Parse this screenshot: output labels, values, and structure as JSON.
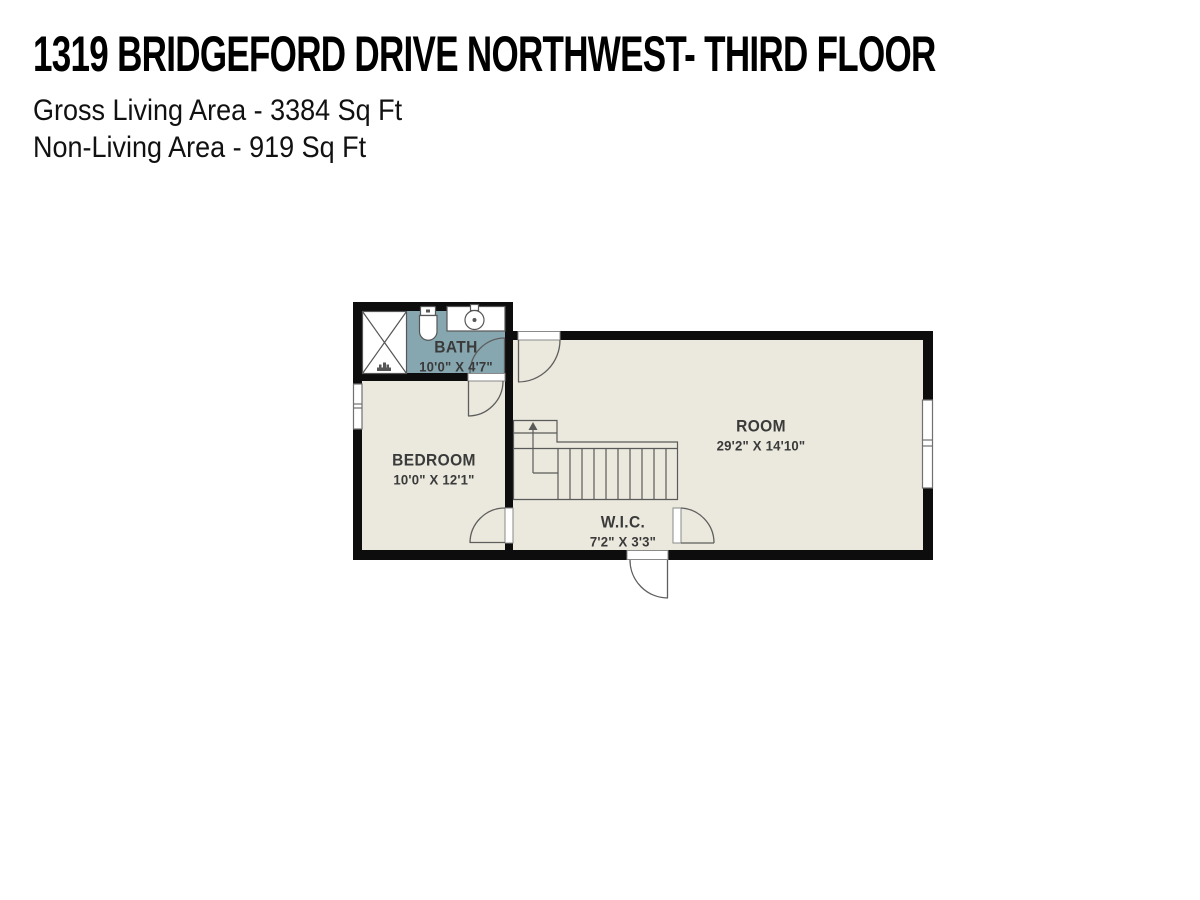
{
  "header": {
    "title": "1319 BRIDGEFORD DRIVE NORTHWEST- THIRD FLOOR",
    "gross_living_area": "Gross Living Area - 3384 Sq Ft",
    "non_living_area": "Non-Living Area - 919 Sq Ft"
  },
  "rooms": [
    {
      "id": "bath",
      "name": "BATH",
      "dims": "10'0\" X 4'7\""
    },
    {
      "id": "bedroom",
      "name": "BEDROOM",
      "dims": "10'0\" X 12'1\""
    },
    {
      "id": "room",
      "name": "ROOM",
      "dims": "29'2\" X 14'10\""
    },
    {
      "id": "wic",
      "name": "W.I.C.",
      "dims": "7'2\" X 3'3\""
    }
  ],
  "colors": {
    "wall": "#0d0d0d",
    "floor": "#ebe9dd",
    "bath_floor": "#86a7b0",
    "fixture_fill": "#ffffff",
    "line": "#606060",
    "label_text": "#3a3a3a"
  }
}
